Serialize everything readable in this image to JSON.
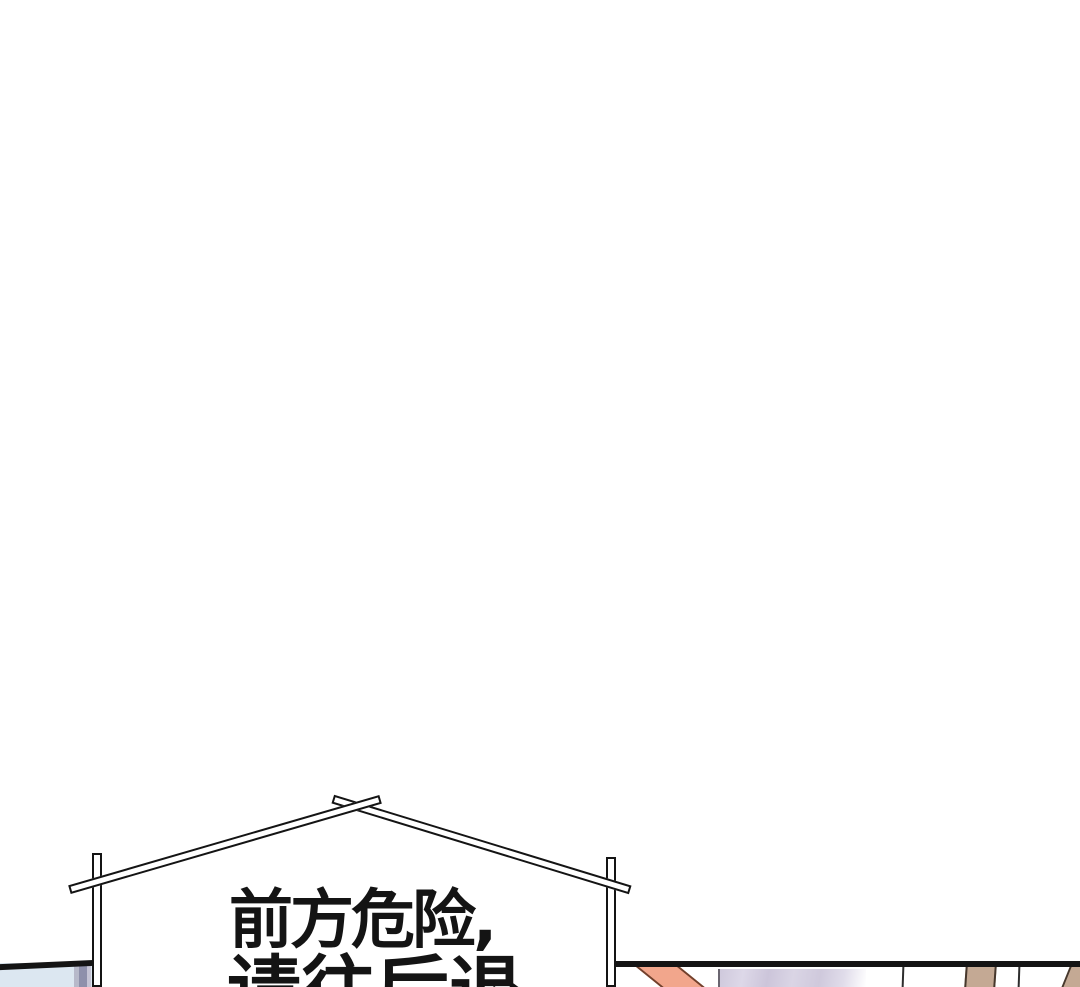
{
  "page": {
    "background": "#ffffff",
    "width": 1080,
    "height": 987
  },
  "sign": {
    "line1": "前方危险,",
    "line2": "请往后退",
    "full_text": "前方危险，请往后退",
    "ink_color": "#141414",
    "plank_fill": "#ffffff"
  },
  "bottom_panels": {
    "left": {
      "sky_color": "#dce7f1",
      "curtain_colors": [
        "#b7b9ca",
        "#8e90ab",
        "#c5c4d5"
      ],
      "border_color": "#141414"
    },
    "right": {
      "border_color": "#141414",
      "beam_color": "#f2a68c",
      "beam_outline": "#71402c",
      "wall_color": "#d5d0df",
      "post_color": "#c4a994",
      "post_outline": "#46382d",
      "fence_line_color": "#2e2e2e"
    }
  }
}
